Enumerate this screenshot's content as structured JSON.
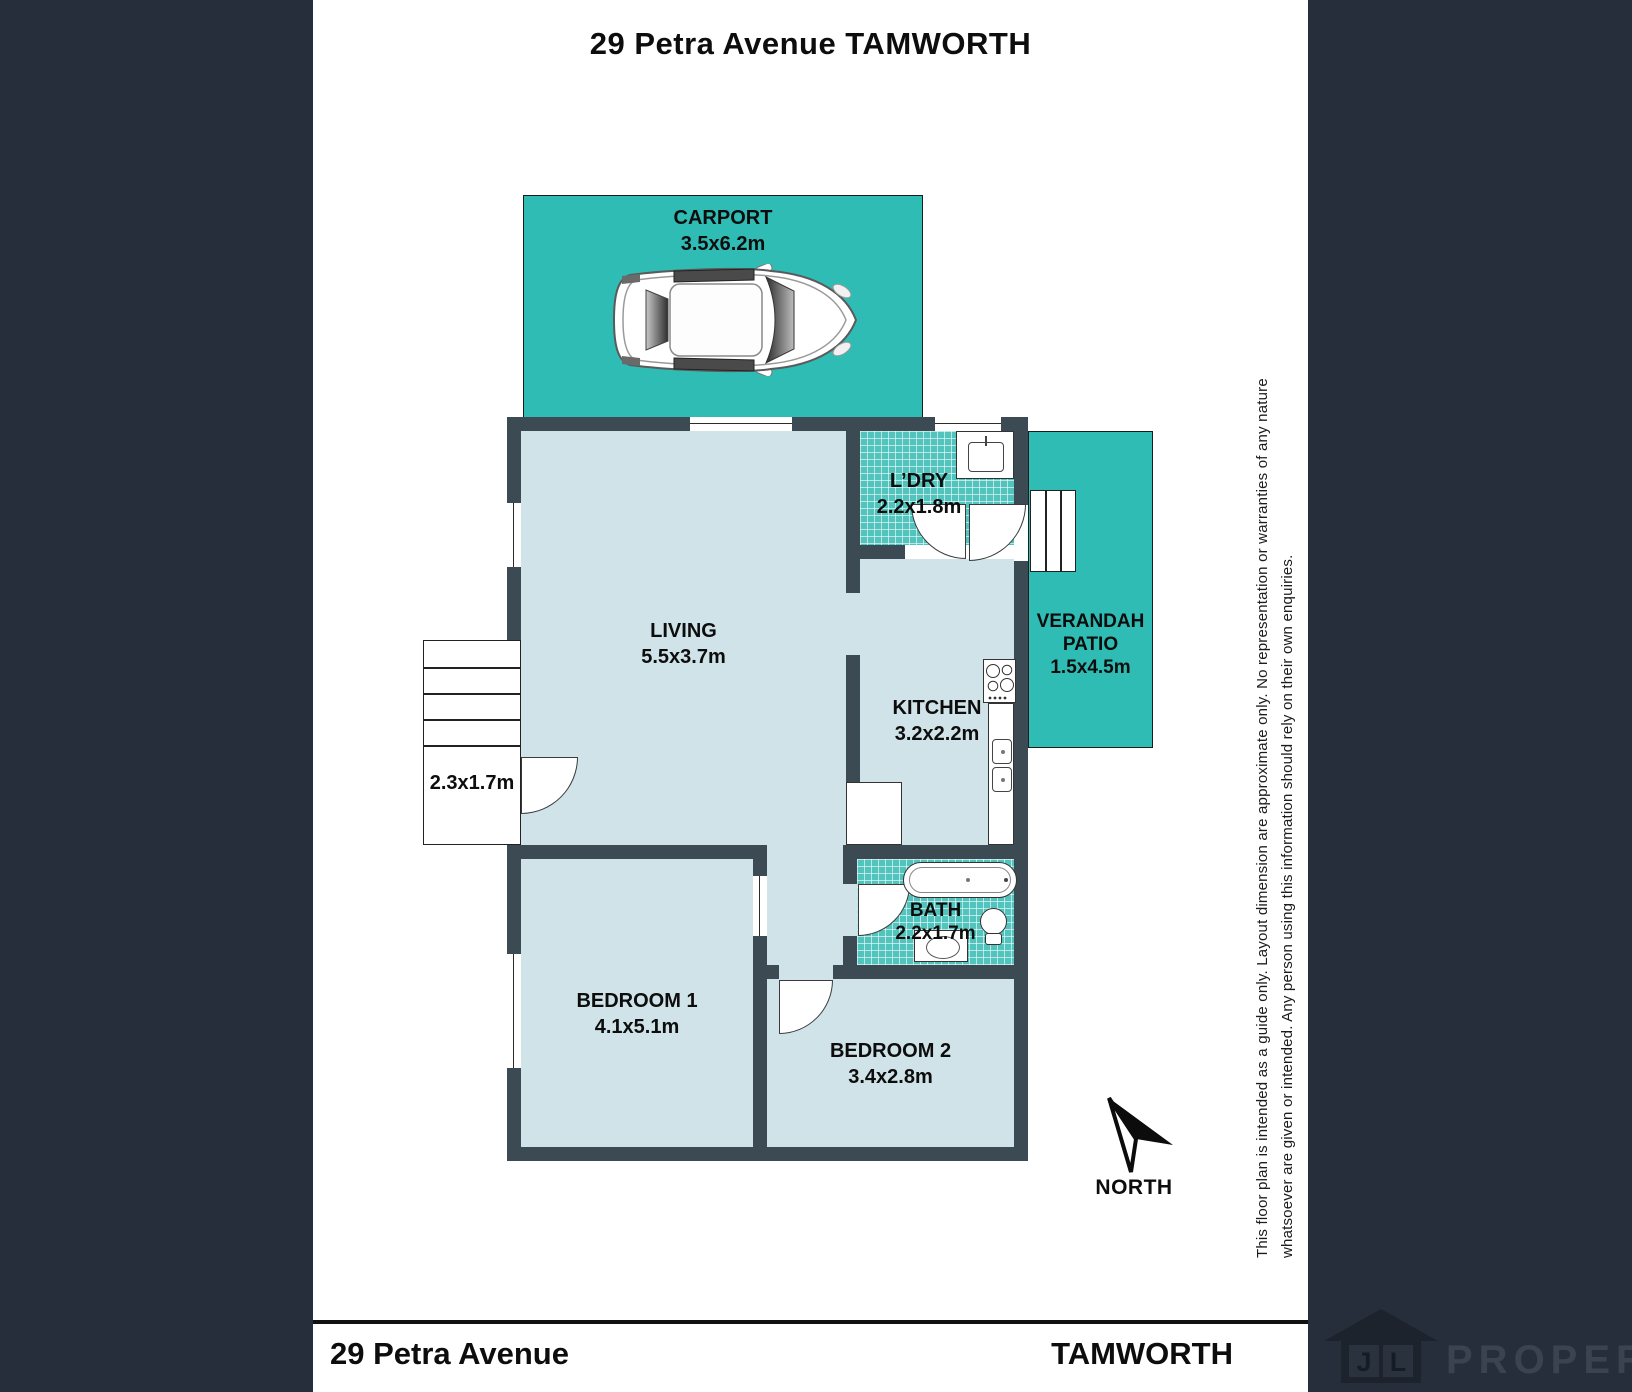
{
  "title": "29 Petra Avenue TAMWORTH",
  "rooms": {
    "carport": {
      "name": "CARPORT",
      "dims": "3.5x6.2m"
    },
    "living": {
      "name": "LIVING",
      "dims": "5.5x3.7m"
    },
    "laundry": {
      "name": "L’DRY",
      "dims": "2.2x1.8m"
    },
    "verandah": {
      "name": "VERANDAH",
      "name2": "PATIO",
      "dims": "1.5x4.5m"
    },
    "kitchen": {
      "name": "KITCHEN",
      "dims": "3.2x2.2m"
    },
    "bath": {
      "name": "BATH",
      "dims": "2.2x1.7m"
    },
    "bedroom1": {
      "name": "BEDROOM 1",
      "dims": "4.1x5.1m"
    },
    "bedroom2": {
      "name": "BEDROOM 2",
      "dims": "3.4x2.8m"
    },
    "entry_steps": {
      "dims": "2.3x1.7m"
    }
  },
  "compass": {
    "label": "NORTH"
  },
  "disclaimer": {
    "line1": "This floor plan is intended as a guide only. Layout dimension are approximate only. No representation or warranties of any nature",
    "line2": "whatsoever are given or intended. Any person using this information should rely on their own enquiries."
  },
  "footer": {
    "address": "29 Petra Avenue",
    "suburb": "TAMWORTH"
  },
  "logo": {
    "letters": [
      "J",
      "L"
    ],
    "name": "PROPERTY"
  },
  "colors": {
    "background": "#272e3b",
    "wall": "#3c4a54",
    "room_fill": "#cfe3e9",
    "teal": "#2fbcb4",
    "tile": "#50c4bd"
  }
}
